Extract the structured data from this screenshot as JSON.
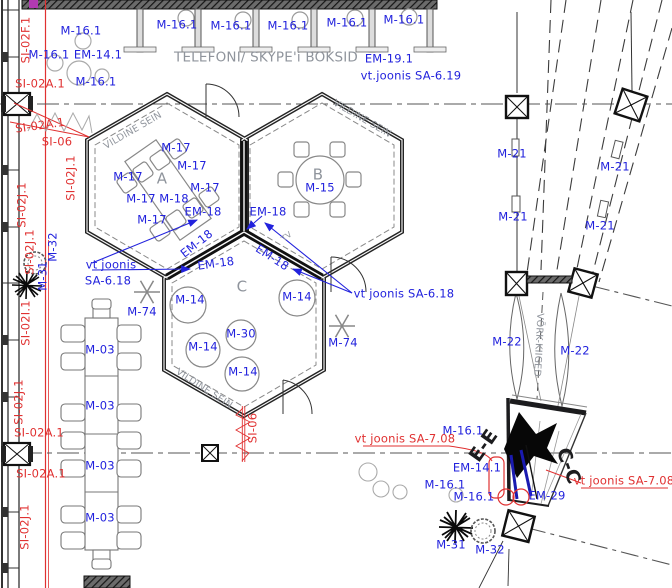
{
  "colors": {
    "blue": "#2222dd",
    "red": "#e03131",
    "gray": "#8f949c",
    "dark": "#1c1c1e"
  },
  "labels": [
    {
      "n": "booth-furniture-label",
      "t": "M-16.1",
      "x": 177,
      "y": 25,
      "c": "blue"
    },
    {
      "n": "booth-furniture-label",
      "t": "M-16.1",
      "x": 231,
      "y": 26,
      "c": "blue"
    },
    {
      "n": "booth-furniture-label",
      "t": "M-16.1",
      "x": 288,
      "y": 26,
      "c": "blue"
    },
    {
      "n": "booth-furniture-label",
      "t": "M-16.1",
      "x": 347,
      "y": 23,
      "c": "blue"
    },
    {
      "n": "booth-furniture-label",
      "t": "M-16.1",
      "x": 404,
      "y": 20,
      "c": "blue"
    },
    {
      "n": "entry-furniture-label",
      "t": "M-16.1",
      "x": 81,
      "y": 31,
      "c": "blue"
    },
    {
      "n": "entry-furniture-label",
      "t": "M-16.1",
      "x": 49,
      "y": 55,
      "c": "blue"
    },
    {
      "n": "entry-furniture-label",
      "t": "EM-14.1",
      "x": 98,
      "y": 55,
      "c": "blue"
    },
    {
      "n": "entry-furniture-label",
      "t": "M-16.1",
      "x": 96,
      "y": 82,
      "c": "blue"
    },
    {
      "n": "wall-code-label",
      "t": "SI-02F.1",
      "x": 26,
      "y": 40,
      "c": "red",
      "r": -90
    },
    {
      "n": "wall-code-label",
      "t": "SI-02A.1",
      "x": 40,
      "y": 84,
      "c": "red"
    },
    {
      "n": "wall-code-label",
      "t": "SI-02A.1",
      "x": 40,
      "y": 126,
      "c": "red",
      "r": -8
    },
    {
      "n": "wall-code-label",
      "t": "SI-06",
      "x": 57,
      "y": 142,
      "c": "red"
    },
    {
      "n": "area-title",
      "t": "TELEFONI/ SKYPE'i BOKSID",
      "x": 266,
      "y": 58,
      "c": "gray",
      "s": 13.5
    },
    {
      "n": "furniture-label",
      "t": "EM-19.1",
      "x": 389,
      "y": 59,
      "c": "blue"
    },
    {
      "n": "reference-note",
      "t": "vt.joonis SA-6.19",
      "x": 411,
      "y": 76,
      "c": "blue"
    },
    {
      "n": "wall-type-label",
      "t": "VILDINE SEIN",
      "x": 133,
      "y": 131,
      "c": "gray",
      "s": 9.5,
      "r": -30
    },
    {
      "n": "wall-type-label",
      "t": "VILDINE SEIN",
      "x": 362,
      "y": 119,
      "c": "gray",
      "s": 9.5,
      "r": 30
    },
    {
      "n": "wall-type-label",
      "t": "VILDINE SEIN",
      "x": 204,
      "y": 389,
      "c": "gray",
      "s": 9.5,
      "r": 33
    },
    {
      "n": "room-letter",
      "t": "A",
      "x": 162,
      "y": 179,
      "c": "gray",
      "s": 15
    },
    {
      "n": "room-letter",
      "t": "B",
      "x": 318,
      "y": 175,
      "c": "gray",
      "s": 15
    },
    {
      "n": "room-letter",
      "t": "C",
      "x": 242,
      "y": 287,
      "c": "gray",
      "s": 15
    },
    {
      "n": "furniture-label",
      "t": "M-17",
      "x": 176,
      "y": 148,
      "c": "blue"
    },
    {
      "n": "furniture-label",
      "t": "M-17",
      "x": 192,
      "y": 166,
      "c": "blue"
    },
    {
      "n": "furniture-label",
      "t": "M-17",
      "x": 128,
      "y": 177,
      "c": "blue"
    },
    {
      "n": "furniture-label",
      "t": "M-17",
      "x": 205,
      "y": 188,
      "c": "blue"
    },
    {
      "n": "furniture-label",
      "t": "M-17",
      "x": 141,
      "y": 199,
      "c": "blue"
    },
    {
      "n": "furniture-label",
      "t": "M-18",
      "x": 174,
      "y": 199,
      "c": "blue"
    },
    {
      "n": "furniture-label",
      "t": "M-17",
      "x": 152,
      "y": 220,
      "c": "blue"
    },
    {
      "n": "furniture-label",
      "t": "M-15",
      "x": 320,
      "y": 188,
      "c": "blue"
    },
    {
      "n": "furniture-label",
      "t": "EM-18",
      "x": 203,
      "y": 212,
      "c": "blue"
    },
    {
      "n": "furniture-label",
      "t": "EM-18",
      "x": 268,
      "y": 212,
      "c": "blue"
    },
    {
      "n": "furniture-label",
      "t": "EM-18",
      "x": 197,
      "y": 244,
      "c": "blue",
      "r": -38
    },
    {
      "n": "furniture-label",
      "t": "EM-18",
      "x": 216,
      "y": 264,
      "c": "blue",
      "r": -8
    },
    {
      "n": "furniture-label",
      "t": "EM-18",
      "x": 272,
      "y": 258,
      "c": "blue",
      "r": 33
    },
    {
      "n": "reference-note",
      "t": "vt joonis",
      "x": 111,
      "y": 265,
      "c": "blue"
    },
    {
      "n": "reference-note",
      "t": "SA-6.18",
      "x": 108,
      "y": 281,
      "c": "blue"
    },
    {
      "n": "reference-note",
      "t": "vt joonis SA-6.18",
      "x": 404,
      "y": 294,
      "c": "blue"
    },
    {
      "n": "furniture-label",
      "t": "M-74",
      "x": 142,
      "y": 312,
      "c": "blue"
    },
    {
      "n": "furniture-label",
      "t": "M-74",
      "x": 343,
      "y": 343,
      "c": "blue"
    },
    {
      "n": "furniture-label",
      "t": "M-14",
      "x": 190,
      "y": 300,
      "c": "blue"
    },
    {
      "n": "furniture-label",
      "t": "M-14",
      "x": 297,
      "y": 297,
      "c": "blue"
    },
    {
      "n": "furniture-label",
      "t": "M-30",
      "x": 241,
      "y": 334,
      "c": "blue"
    },
    {
      "n": "furniture-label",
      "t": "M-14",
      "x": 203,
      "y": 347,
      "c": "blue"
    },
    {
      "n": "furniture-label",
      "t": "M-14",
      "x": 243,
      "y": 372,
      "c": "blue"
    },
    {
      "n": "furniture-label",
      "t": "M-03",
      "x": 100,
      "y": 350,
      "c": "blue"
    },
    {
      "n": "furniture-label",
      "t": "M-03",
      "x": 100,
      "y": 406,
      "c": "blue"
    },
    {
      "n": "furniture-label",
      "t": "M-03",
      "x": 100,
      "y": 466,
      "c": "blue"
    },
    {
      "n": "furniture-label",
      "t": "M-03",
      "x": 100,
      "y": 518,
      "c": "blue"
    },
    {
      "n": "wall-code-label",
      "t": "SI-02J.1",
      "x": 71,
      "y": 178,
      "c": "red",
      "r": -90
    },
    {
      "n": "wall-code-label",
      "t": "SI-02J.1",
      "x": 22,
      "y": 205,
      "c": "red",
      "r": -90
    },
    {
      "n": "wall-code-label",
      "t": "SI-02J.1",
      "x": 30,
      "y": 252,
      "c": "red",
      "r": -90
    },
    {
      "n": "wall-code-label",
      "t": "SI-02I.1",
      "x": 26,
      "y": 323,
      "c": "red",
      "r": -90
    },
    {
      "n": "wall-code-label",
      "t": "SI-02J.1",
      "x": 19,
      "y": 402,
      "c": "red",
      "r": -90
    },
    {
      "n": "wall-code-label",
      "t": "SI-02A.1",
      "x": 39,
      "y": 433,
      "c": "red"
    },
    {
      "n": "wall-code-label",
      "t": "SI-02A.1",
      "x": 41,
      "y": 474,
      "c": "red"
    },
    {
      "n": "wall-code-label",
      "t": "SI-02J.1",
      "x": 25,
      "y": 527,
      "c": "red",
      "r": -90
    },
    {
      "n": "wall-code-label",
      "t": "SI-06",
      "x": 253,
      "y": 428,
      "c": "red",
      "r": -90
    },
    {
      "n": "plant-label",
      "t": "M-32",
      "x": 53,
      "y": 247,
      "c": "blue",
      "r": -90
    },
    {
      "n": "plant-label",
      "t": "M-31",
      "x": 43,
      "y": 276,
      "c": "blue",
      "r": -90
    },
    {
      "n": "furniture-label",
      "t": "M-21",
      "x": 512,
      "y": 154,
      "c": "blue"
    },
    {
      "n": "furniture-label",
      "t": "M-21",
      "x": 615,
      "y": 167,
      "c": "blue"
    },
    {
      "n": "furniture-label",
      "t": "M-21",
      "x": 513,
      "y": 217,
      "c": "blue"
    },
    {
      "n": "furniture-label",
      "t": "M-21",
      "x": 600,
      "y": 226,
      "c": "blue"
    },
    {
      "n": "furniture-label",
      "t": "M-22",
      "x": 507,
      "y": 342,
      "c": "blue"
    },
    {
      "n": "furniture-label",
      "t": "M-22",
      "x": 575,
      "y": 351,
      "c": "blue"
    },
    {
      "n": "swing-area-label",
      "t": "VÕRK-KIIGED",
      "x": 538,
      "y": 345,
      "c": "gray",
      "s": 9.5,
      "r": 93
    },
    {
      "n": "furniture-label",
      "t": "M-16.1",
      "x": 463,
      "y": 431,
      "c": "blue"
    },
    {
      "n": "furniture-label",
      "t": "EM-14.1",
      "x": 477,
      "y": 468,
      "c": "blue"
    },
    {
      "n": "furniture-label",
      "t": "M-16.1",
      "x": 445,
      "y": 485,
      "c": "blue"
    },
    {
      "n": "furniture-label",
      "t": "M-16.1",
      "x": 474,
      "y": 497,
      "c": "blue"
    },
    {
      "n": "furniture-label",
      "t": "EM-29",
      "x": 547,
      "y": 496,
      "c": "blue"
    },
    {
      "n": "reference-note-red",
      "t": "vt joonis SA-7.08",
      "x": 405,
      "y": 439,
      "c": "red"
    },
    {
      "n": "reference-note-red",
      "t": "vt joonis SA-7.08",
      "x": 624,
      "y": 481,
      "c": "red"
    },
    {
      "n": "section-mark-label",
      "t": "E-E",
      "x": 484,
      "y": 446,
      "c": "dark",
      "s": 19,
      "b": 1,
      "r": -55
    },
    {
      "n": "section-mark-label",
      "t": "C-C",
      "x": 568,
      "y": 466,
      "c": "dark",
      "s": 19,
      "b": 1,
      "r": 70
    },
    {
      "n": "plant-label",
      "t": "M-31",
      "x": 451,
      "y": 545,
      "c": "blue"
    },
    {
      "n": "plant-label",
      "t": "M-32",
      "x": 490,
      "y": 550,
      "c": "blue"
    },
    {
      "n": "tv-label",
      "t": "TV",
      "x": 287,
      "y": 237,
      "c": "gray",
      "s": 8,
      "r": -38
    }
  ]
}
